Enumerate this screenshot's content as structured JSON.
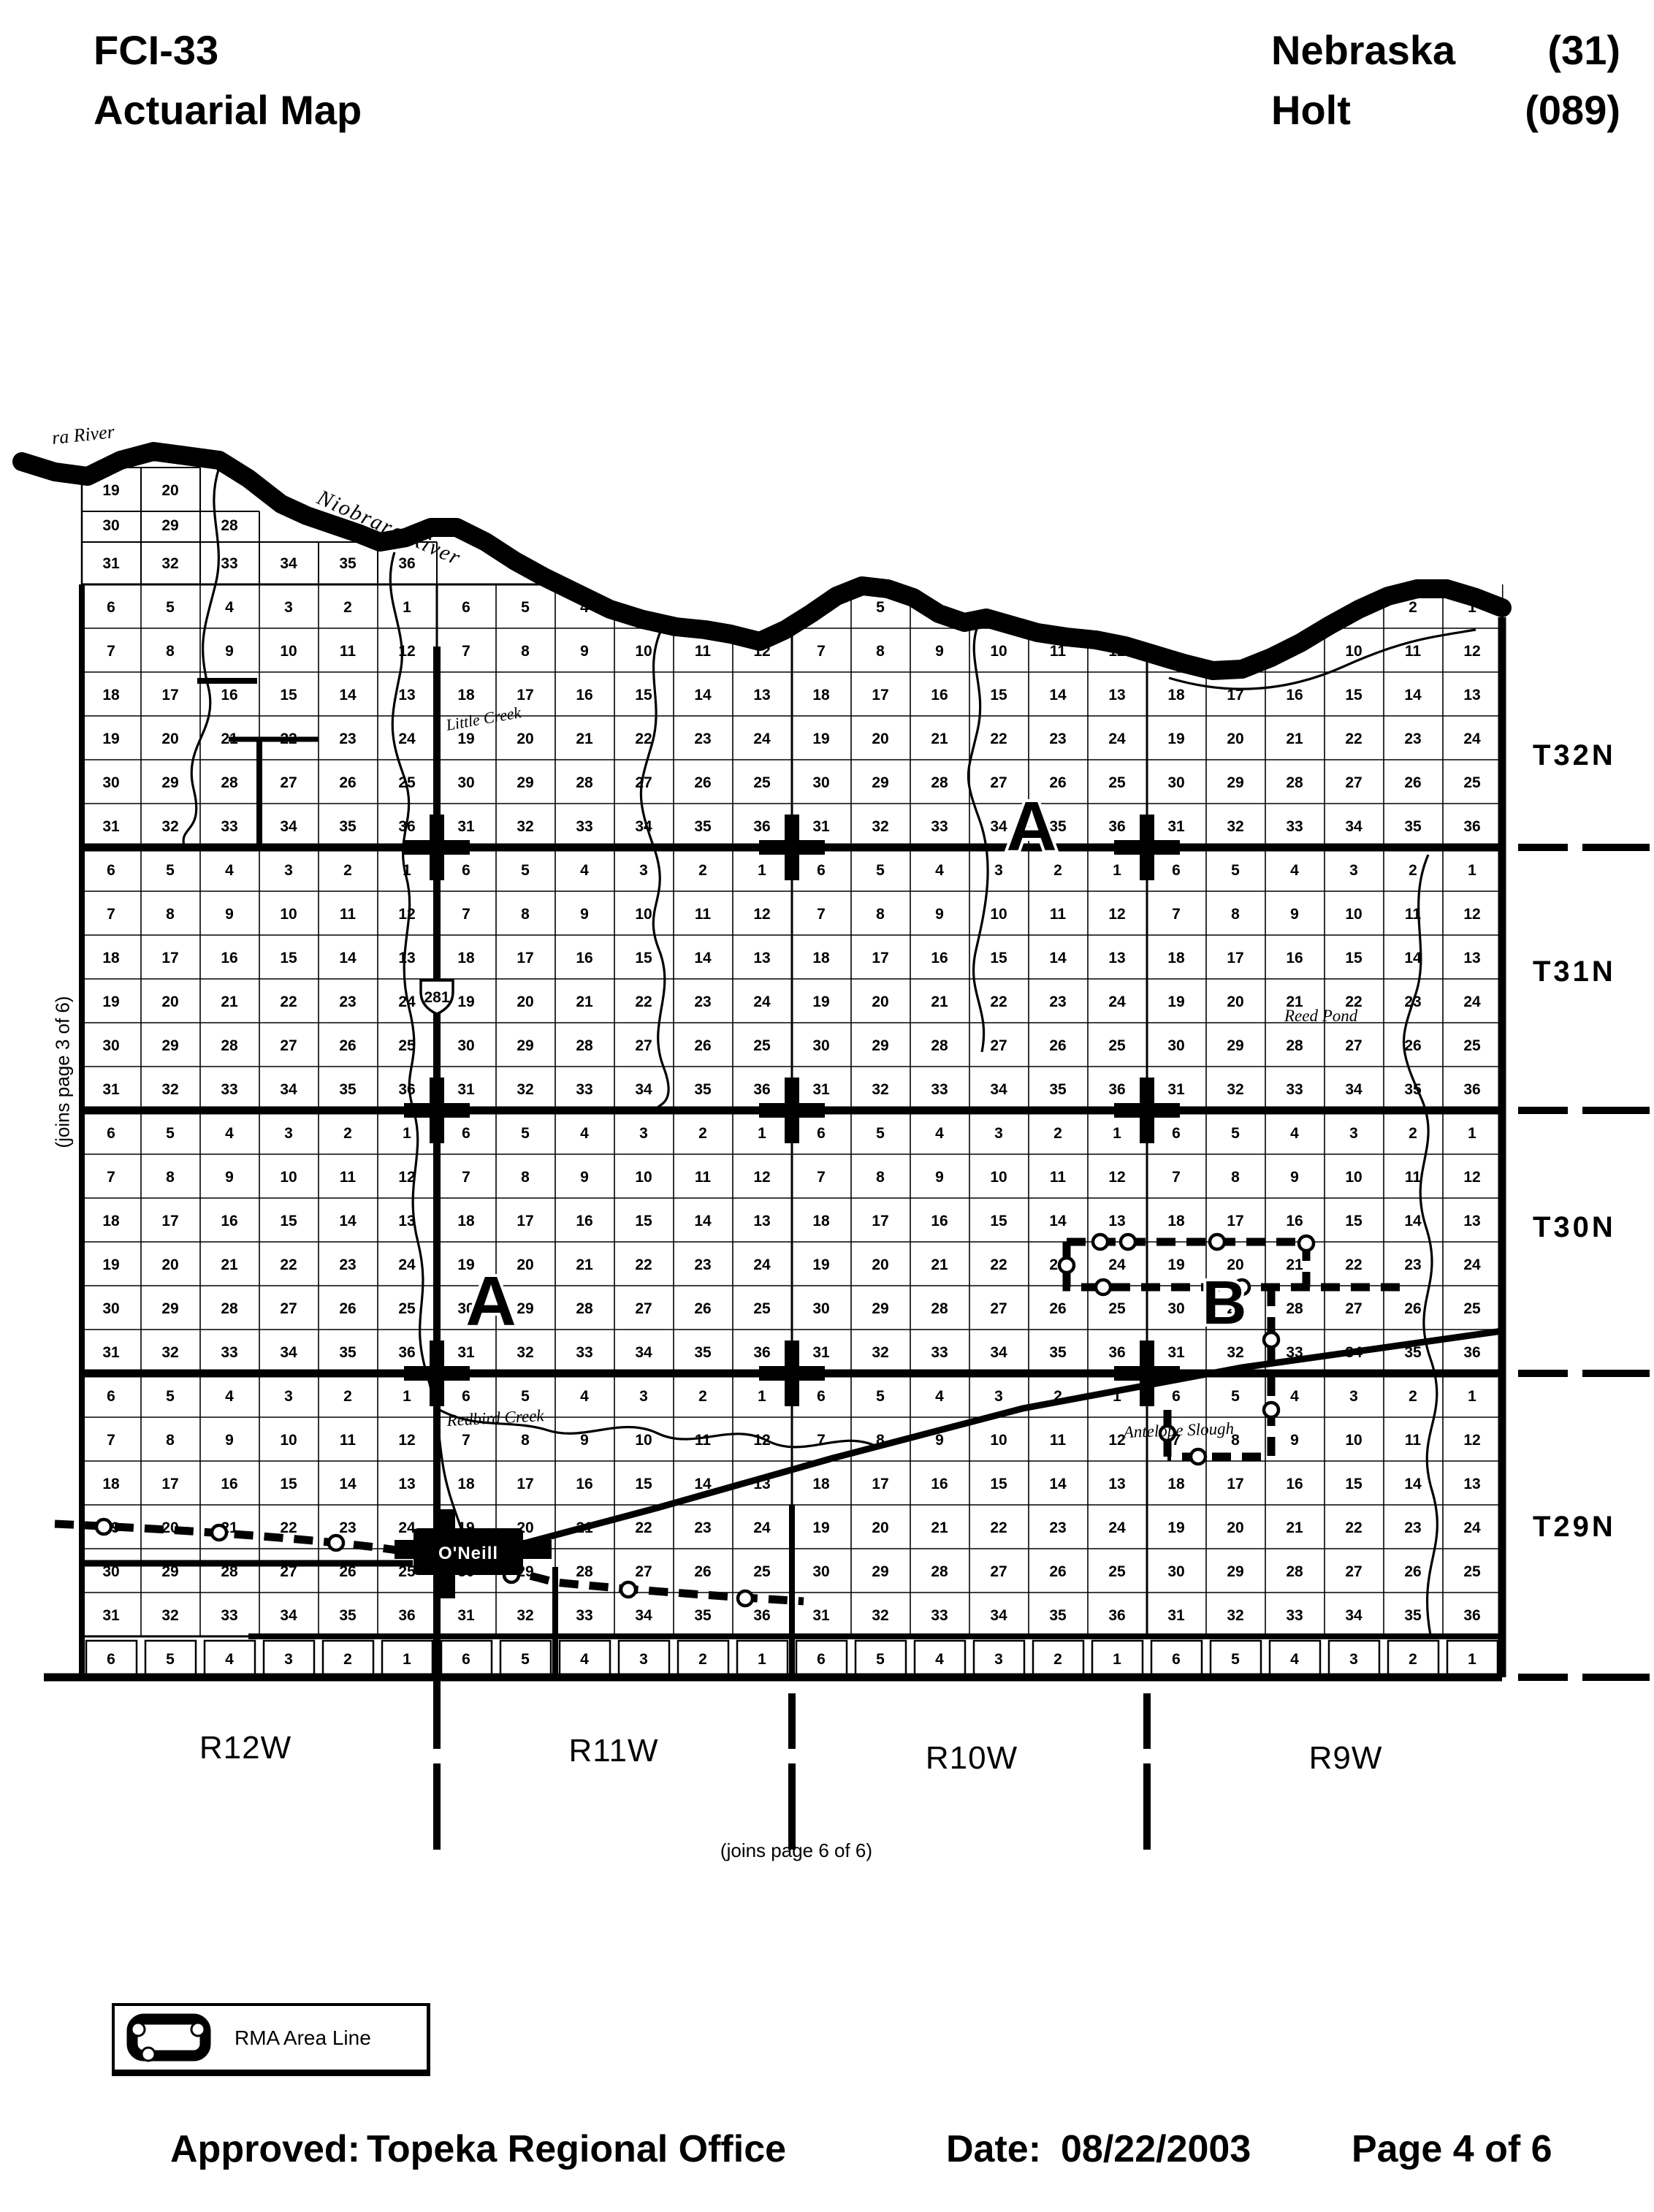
{
  "header": {
    "form_id": "FCI-33",
    "title": "Actuarial Map",
    "state": "Nebraska",
    "state_code": "(31)",
    "county": "Holt",
    "county_code": "(089)"
  },
  "map": {
    "township_labels": [
      "T32N",
      "T31N",
      "T30N",
      "T29N"
    ],
    "range_labels": [
      "R12W",
      "R11W",
      "R10W",
      "R9W"
    ],
    "section_rows": [
      [
        6,
        5,
        4,
        3,
        2,
        1
      ],
      [
        7,
        8,
        9,
        10,
        11,
        12
      ],
      [
        18,
        17,
        16,
        15,
        14,
        13
      ],
      [
        19,
        20,
        21,
        22,
        23,
        24
      ],
      [
        30,
        29,
        28,
        27,
        26,
        25
      ],
      [
        31,
        32,
        33,
        34,
        35,
        36
      ]
    ],
    "partial_top_rows": [
      [
        19,
        20
      ],
      [
        30,
        29,
        28
      ],
      [
        31,
        32,
        33,
        34,
        35,
        36
      ]
    ],
    "partial_bottom_row": [
      6,
      5,
      4,
      3,
      2,
      1
    ],
    "water_labels": {
      "river_fragment": "ra River",
      "river": "Niobrara River",
      "creek_little": "Little Creek",
      "creek_redbird": "Redbird Creek",
      "slough": "Antelope Slough",
      "pond": "Reed Pond"
    },
    "town": "O'Neill",
    "highway_shield": "281",
    "area_markers": [
      {
        "letter": "A"
      },
      {
        "letter": "A"
      },
      {
        "letter": "B"
      }
    ],
    "join_left": "(joins page 3 of 6)",
    "join_bottom": "(joins page 6 of 6)"
  },
  "legend": {
    "rma_label": "RMA Area Line"
  },
  "footer": {
    "approved_label": "Approved:",
    "approved_value": "Topeka Regional Office",
    "date_label": "Date:",
    "date_value": "08/22/2003",
    "page_label": "Page 4 of 6"
  },
  "colors": {
    "ink": "#000000",
    "paper": "#ffffff"
  }
}
